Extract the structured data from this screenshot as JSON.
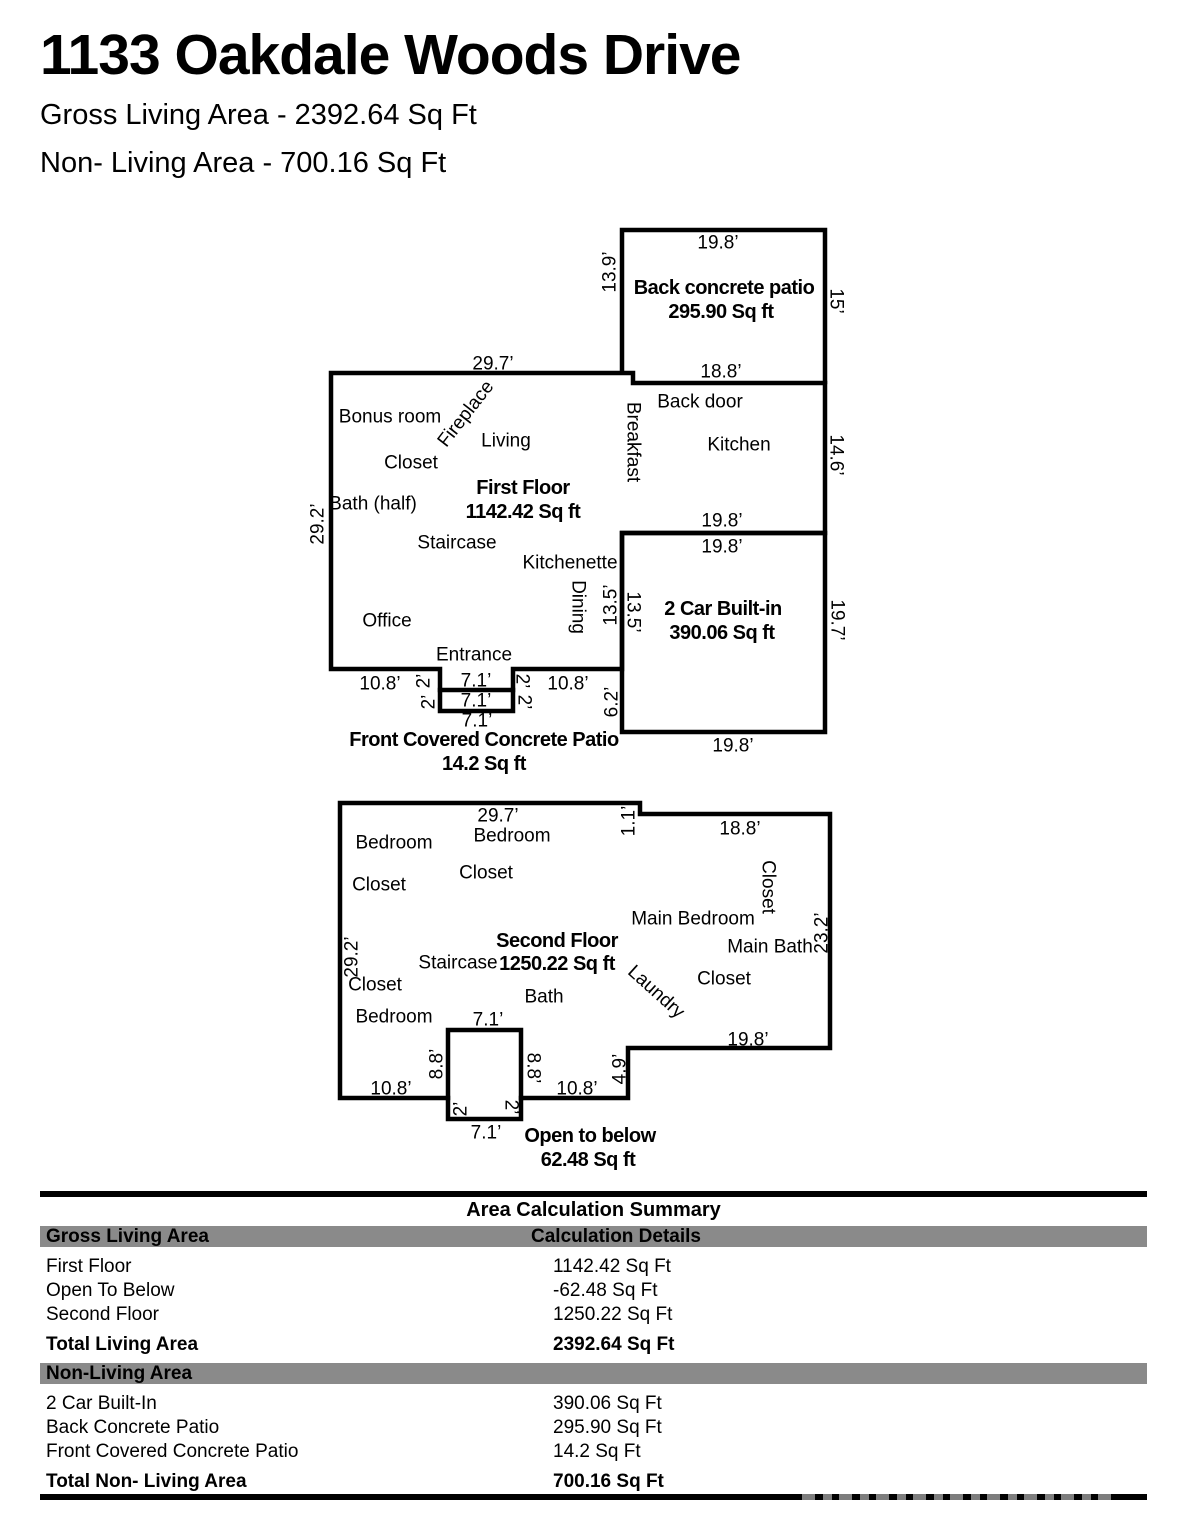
{
  "header": {
    "title": "1133 Oakdale Woods Drive",
    "gross_line": "Gross Living Area - 2392.64 Sq Ft",
    "non_living_line": "Non- Living Area - 700.16 Sq Ft"
  },
  "floorplan": {
    "labels": [
      {
        "t": "19.8’",
        "x": 718,
        "y": 243,
        "r": 0,
        "c": "dim"
      },
      {
        "t": "13.9’",
        "x": 610,
        "y": 272,
        "r": -90,
        "c": "dim"
      },
      {
        "t": "Back concrete patio",
        "x": 724,
        "y": 288,
        "r": 0,
        "c": "area"
      },
      {
        "t": "295.90 Sq ft",
        "x": 721,
        "y": 312,
        "r": 0,
        "c": "area"
      },
      {
        "t": "15’",
        "x": 836,
        "y": 301,
        "r": 90,
        "c": "dim"
      },
      {
        "t": "18.8’",
        "x": 721,
        "y": 372,
        "r": 0,
        "c": "dim"
      },
      {
        "t": "29.7’",
        "x": 493,
        "y": 364,
        "r": 0,
        "c": "dim"
      },
      {
        "t": "Back door",
        "x": 700,
        "y": 402,
        "r": 0,
        "c": "room"
      },
      {
        "t": "Bonus room",
        "x": 390,
        "y": 417,
        "r": 0,
        "c": "room"
      },
      {
        "t": "Fireplace",
        "x": 466,
        "y": 414,
        "r": -52,
        "c": "room"
      },
      {
        "t": "Living",
        "x": 506,
        "y": 441,
        "r": 0,
        "c": "room"
      },
      {
        "t": "Breakfast",
        "x": 633,
        "y": 442,
        "r": 90,
        "c": "room"
      },
      {
        "t": "Kitchen",
        "x": 739,
        "y": 445,
        "r": 0,
        "c": "room"
      },
      {
        "t": "Closet",
        "x": 411,
        "y": 463,
        "r": 0,
        "c": "room"
      },
      {
        "t": "14.6’",
        "x": 836,
        "y": 455,
        "r": 90,
        "c": "dim"
      },
      {
        "t": "First Floor",
        "x": 523,
        "y": 488,
        "r": 0,
        "c": "area"
      },
      {
        "t": "1142.42 Sq ft",
        "x": 523,
        "y": 512,
        "r": 0,
        "c": "area"
      },
      {
        "t": "Bath (half)",
        "x": 373,
        "y": 504,
        "r": 0,
        "c": "room"
      },
      {
        "t": "29.2’",
        "x": 318,
        "y": 524,
        "r": -90,
        "c": "dim"
      },
      {
        "t": "19.8’",
        "x": 722,
        "y": 521,
        "r": 0,
        "c": "dim"
      },
      {
        "t": "19.8’",
        "x": 722,
        "y": 547,
        "r": 0,
        "c": "dim"
      },
      {
        "t": "Staircase",
        "x": 457,
        "y": 543,
        "r": 0,
        "c": "room"
      },
      {
        "t": "Kitchenette",
        "x": 570,
        "y": 563,
        "r": 0,
        "c": "room"
      },
      {
        "t": "Dining",
        "x": 578,
        "y": 607,
        "r": 90,
        "c": "room"
      },
      {
        "t": "13.5’",
        "x": 611,
        "y": 605,
        "r": -90,
        "c": "dim"
      },
      {
        "t": "13.5’",
        "x": 633,
        "y": 612,
        "r": 90,
        "c": "dim"
      },
      {
        "t": "2 Car Built-in",
        "x": 723,
        "y": 609,
        "r": 0,
        "c": "area"
      },
      {
        "t": "390.06 Sq ft",
        "x": 722,
        "y": 633,
        "r": 0,
        "c": "area"
      },
      {
        "t": "19.7’",
        "x": 837,
        "y": 620,
        "r": 90,
        "c": "dim"
      },
      {
        "t": "Office",
        "x": 387,
        "y": 621,
        "r": 0,
        "c": "room"
      },
      {
        "t": "Entrance",
        "x": 474,
        "y": 655,
        "r": 0,
        "c": "room"
      },
      {
        "t": "10.8’",
        "x": 380,
        "y": 684,
        "r": 0,
        "c": "dim"
      },
      {
        "t": "2’",
        "x": 424,
        "y": 681,
        "r": -90,
        "c": "dim"
      },
      {
        "t": "2’",
        "x": 429,
        "y": 702,
        "r": -90,
        "c": "dim"
      },
      {
        "t": "7.1’",
        "x": 476,
        "y": 681,
        "r": 0,
        "c": "dim"
      },
      {
        "t": "7.1’",
        "x": 476,
        "y": 701,
        "r": 0,
        "c": "dim"
      },
      {
        "t": "2’",
        "x": 522,
        "y": 681,
        "r": 90,
        "c": "dim"
      },
      {
        "t": "2’",
        "x": 524,
        "y": 702,
        "r": 90,
        "c": "dim"
      },
      {
        "t": "10.8’",
        "x": 568,
        "y": 684,
        "r": 0,
        "c": "dim"
      },
      {
        "t": "6.2’",
        "x": 612,
        "y": 702,
        "r": -90,
        "c": "dim"
      },
      {
        "t": "7.1’",
        "x": 477,
        "y": 721,
        "r": 0,
        "c": "dim"
      },
      {
        "t": "Front Covered Concrete Patio",
        "x": 484,
        "y": 740,
        "r": 0,
        "c": "area"
      },
      {
        "t": "14.2 Sq ft",
        "x": 484,
        "y": 764,
        "r": 0,
        "c": "area"
      },
      {
        "t": "19.8’",
        "x": 733,
        "y": 746,
        "r": 0,
        "c": "dim"
      },
      {
        "t": "29.7’",
        "x": 498,
        "y": 816,
        "r": 0,
        "c": "dim"
      },
      {
        "t": "1.1’",
        "x": 629,
        "y": 821,
        "r": -90,
        "c": "dim"
      },
      {
        "t": "18.8’",
        "x": 740,
        "y": 829,
        "r": 0,
        "c": "dim"
      },
      {
        "t": "Bedroom",
        "x": 394,
        "y": 843,
        "r": 0,
        "c": "room"
      },
      {
        "t": "Bedroom",
        "x": 512,
        "y": 836,
        "r": 0,
        "c": "room"
      },
      {
        "t": "Closet",
        "x": 486,
        "y": 873,
        "r": 0,
        "c": "room"
      },
      {
        "t": "Closet",
        "x": 379,
        "y": 885,
        "r": 0,
        "c": "room"
      },
      {
        "t": "Closet",
        "x": 768,
        "y": 887,
        "r": 90,
        "c": "room"
      },
      {
        "t": "Main Bedroom",
        "x": 693,
        "y": 919,
        "r": 0,
        "c": "room"
      },
      {
        "t": "Main Bath",
        "x": 770,
        "y": 947,
        "r": 0,
        "c": "room"
      },
      {
        "t": "23.2’",
        "x": 822,
        "y": 933,
        "r": -90,
        "c": "dim"
      },
      {
        "t": "Second Floor",
        "x": 557,
        "y": 941,
        "r": 0,
        "c": "area"
      },
      {
        "t": "1250.22 Sq ft",
        "x": 557,
        "y": 964,
        "r": 0,
        "c": "area"
      },
      {
        "t": "Staircase",
        "x": 458,
        "y": 963,
        "r": 0,
        "c": "room"
      },
      {
        "t": "29.2’",
        "x": 352,
        "y": 957,
        "r": -90,
        "c": "dim"
      },
      {
        "t": "Laundry",
        "x": 656,
        "y": 992,
        "r": 42,
        "c": "room"
      },
      {
        "t": "Closet",
        "x": 724,
        "y": 979,
        "r": 0,
        "c": "room"
      },
      {
        "t": "Closet",
        "x": 375,
        "y": 985,
        "r": 0,
        "c": "room"
      },
      {
        "t": "Bath",
        "x": 544,
        "y": 997,
        "r": 0,
        "c": "room"
      },
      {
        "t": "Bedroom",
        "x": 394,
        "y": 1017,
        "r": 0,
        "c": "room"
      },
      {
        "t": "7.1’",
        "x": 488,
        "y": 1020,
        "r": 0,
        "c": "dim"
      },
      {
        "t": "19.8’",
        "x": 748,
        "y": 1040,
        "r": 0,
        "c": "dim"
      },
      {
        "t": "8.8’",
        "x": 437,
        "y": 1064,
        "r": -90,
        "c": "dim"
      },
      {
        "t": "8.8’",
        "x": 533,
        "y": 1068,
        "r": 90,
        "c": "dim"
      },
      {
        "t": "4.9’",
        "x": 620,
        "y": 1069,
        "r": -90,
        "c": "dim"
      },
      {
        "t": "10.8’",
        "x": 391,
        "y": 1089,
        "r": 0,
        "c": "dim"
      },
      {
        "t": "10.8’",
        "x": 577,
        "y": 1089,
        "r": 0,
        "c": "dim"
      },
      {
        "t": "2’",
        "x": 461,
        "y": 1109,
        "r": -90,
        "c": "dim"
      },
      {
        "t": "2’",
        "x": 511,
        "y": 1107,
        "r": 90,
        "c": "dim"
      },
      {
        "t": "7.1’",
        "x": 486,
        "y": 1133,
        "r": 0,
        "c": "dim"
      },
      {
        "t": "Open to below",
        "x": 590,
        "y": 1136,
        "r": 0,
        "c": "area"
      },
      {
        "t": "62.48 Sq ft",
        "x": 588,
        "y": 1160,
        "r": 0,
        "c": "area"
      }
    ]
  },
  "summary": {
    "title": "Area Calculation Summary",
    "col1_header": "Gross Living Area",
    "col2_header": "Calculation Details",
    "gross_rows": [
      {
        "label": "First Floor",
        "value": "1142.42 Sq Ft"
      },
      {
        "label": "Open To Below",
        "value": "-62.48 Sq Ft"
      },
      {
        "label": "Second Floor",
        "value": "1250.22 Sq Ft"
      }
    ],
    "total_living": {
      "label": "Total Living Area",
      "value": "2392.64 Sq Ft"
    },
    "nonliving_header": "Non-Living Area",
    "nonliving_rows": [
      {
        "label": "2 Car Built-In",
        "value": "390.06 Sq Ft"
      },
      {
        "label": "Back Concrete Patio",
        "value": "295.90 Sq Ft"
      },
      {
        "label": "Front Covered Concrete Patio",
        "value": "14.2 Sq Ft"
      }
    ],
    "total_nonliving": {
      "label": "Total Non- Living Area",
      "value": "700.16 Sq Ft"
    }
  },
  "colors": {
    "wall": "#000000",
    "table_bar_gray": "#8a8a8a",
    "table_bar_black": "#000000"
  }
}
